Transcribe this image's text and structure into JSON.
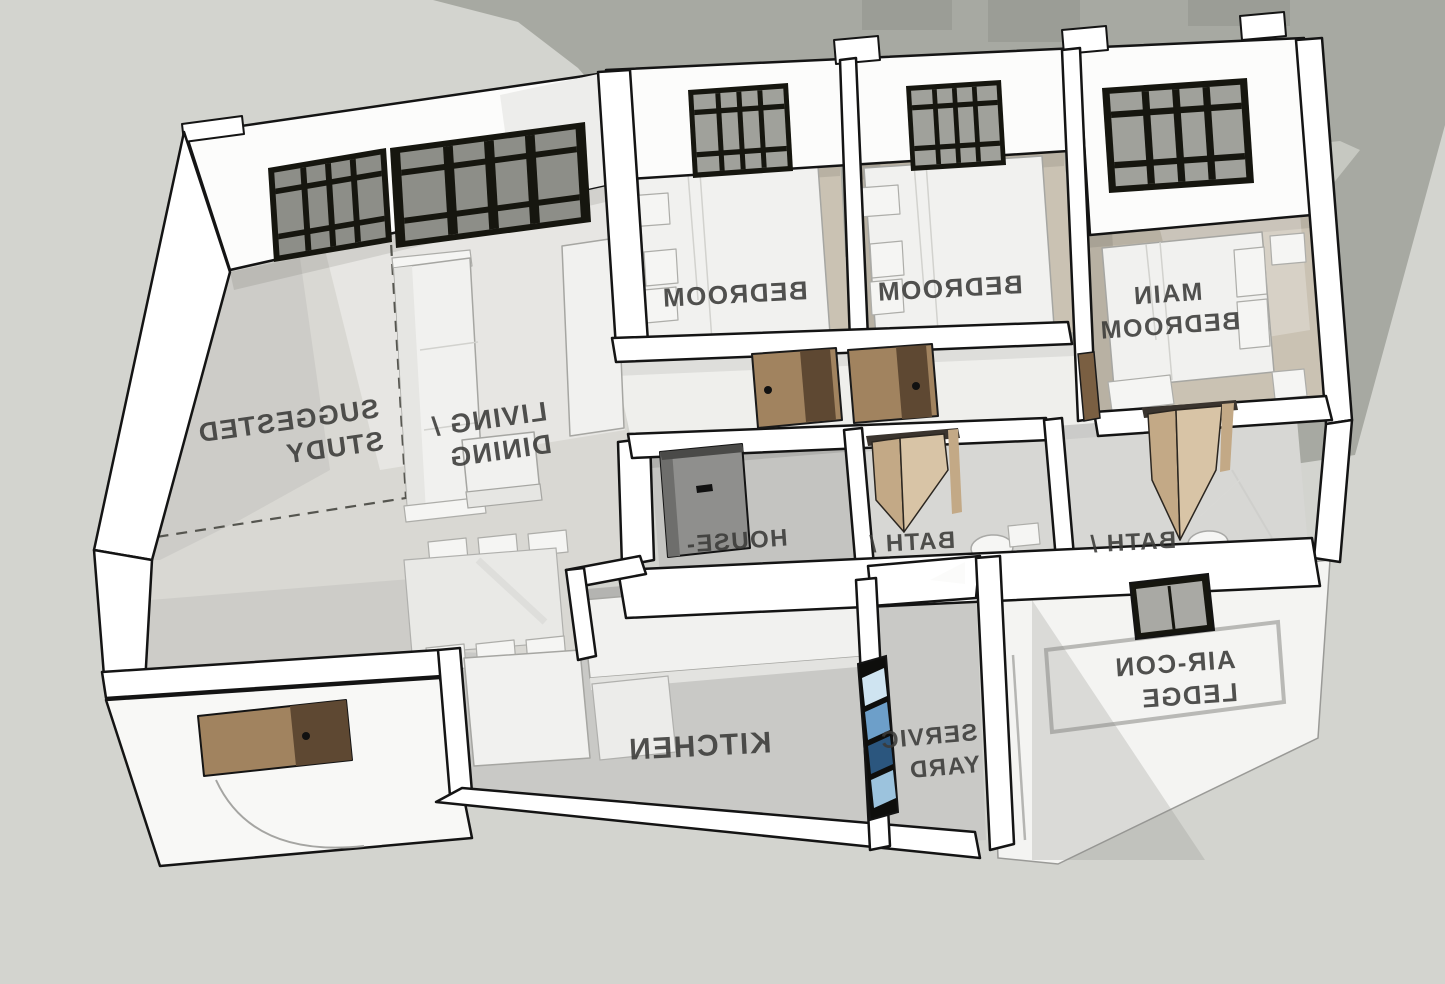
{
  "scene": {
    "title": "3D axonometric floor plan, white sketch-model style",
    "text_mirrored": true,
    "view": "top-down oblique from behind (room labels appear mirrored)"
  },
  "rooms": [
    {
      "id": "bedroom-1",
      "lines": [
        "BEDROOM"
      ]
    },
    {
      "id": "bedroom-2",
      "lines": [
        "BEDROOM"
      ]
    },
    {
      "id": "main-bedroom",
      "lines": [
        "MAIN",
        "BEDROOM"
      ]
    },
    {
      "id": "suggested-study",
      "lines": [
        "SUGGESTED",
        "STUDY"
      ]
    },
    {
      "id": "living-dining",
      "lines": [
        "LIVING /",
        "DINING"
      ]
    },
    {
      "id": "household-shelter",
      "lines": [
        "HOUSE-"
      ]
    },
    {
      "id": "bath-1",
      "lines": [
        "BATH /"
      ]
    },
    {
      "id": "bath-2",
      "lines": [
        "BATH /"
      ]
    },
    {
      "id": "kitchen",
      "lines": [
        "KITCHEN"
      ]
    },
    {
      "id": "service-yard",
      "lines": [
        "SERVIC",
        "YARD"
      ]
    },
    {
      "id": "aircon-ledge",
      "lines": [
        "AIR-CON",
        "LEDGE"
      ]
    }
  ],
  "colors": {
    "background": "#d3d4cf",
    "cast_shadow": "#a7a9a2",
    "shadow_stripe": "#c6c8c1",
    "wall": "#ffffff",
    "outline": "#141414",
    "bedroom_floor": "#cac2b3",
    "living_floor": "#d9d8d3",
    "hall_floor": "#efefec",
    "bath_floor": "#d7d7d4",
    "shelter_floor": "#c4c4c1",
    "kitchen_floor": "#c9c9c6",
    "service_floor": "#c9c9c6",
    "porch": "#f8f8f6",
    "ledge": "#f4f4f2",
    "door_wood": "#a1835f",
    "door_wood_dark": "#5e4832",
    "bifold_wood": "#c3a986",
    "bifold_wood_light": "#d8c4a6",
    "shelter_door": "#8f8f8d",
    "window_frame": "#16160f",
    "window_glass": "#9fa09b",
    "louver_blue": "#6d9fc9",
    "label_text": "#3a3a38"
  }
}
